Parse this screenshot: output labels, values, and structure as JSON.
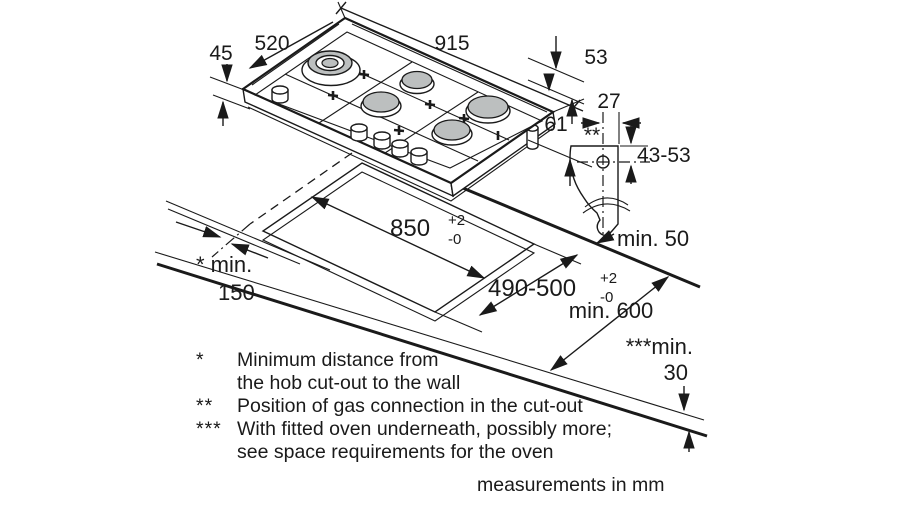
{
  "dimensions": {
    "hob_width": "915",
    "hob_depth": "520",
    "hob_height_front": "45",
    "hob_height_right": "53",
    "hob_depth_below": "61",
    "gas_connection_offset": "27",
    "gas_connection_marker": "**",
    "gas_connection_height": "43-53",
    "cutout_length": "850",
    "cutout_length_tol_plus": "+2",
    "cutout_length_tol_minus": "-0",
    "cutout_depth": "490-500",
    "cutout_depth_tol_plus": "+2",
    "cutout_depth_tol_minus": "-0",
    "rear_clearance": "min. 50",
    "wall_clearance_line1": "* min.",
    "wall_clearance_line2": "150",
    "worktop_depth": "min. 600",
    "oven_clearance_line1": "***min.",
    "oven_clearance_line2": "30"
  },
  "footnotes": [
    {
      "marker": "*",
      "line1": "Minimum distance from",
      "line2": "the hob cut-out to the wall"
    },
    {
      "marker": "**",
      "line1": "Position of gas connection in the cut-out"
    },
    {
      "marker": "***",
      "line1": "With fitted oven underneath, possibly more;",
      "line2": "see space requirements for the oven"
    }
  ],
  "note": "measurements in mm",
  "colors": {
    "line": "#1a1a1a",
    "burner_fill": "#bcbfbf",
    "background": "#ffffff"
  }
}
